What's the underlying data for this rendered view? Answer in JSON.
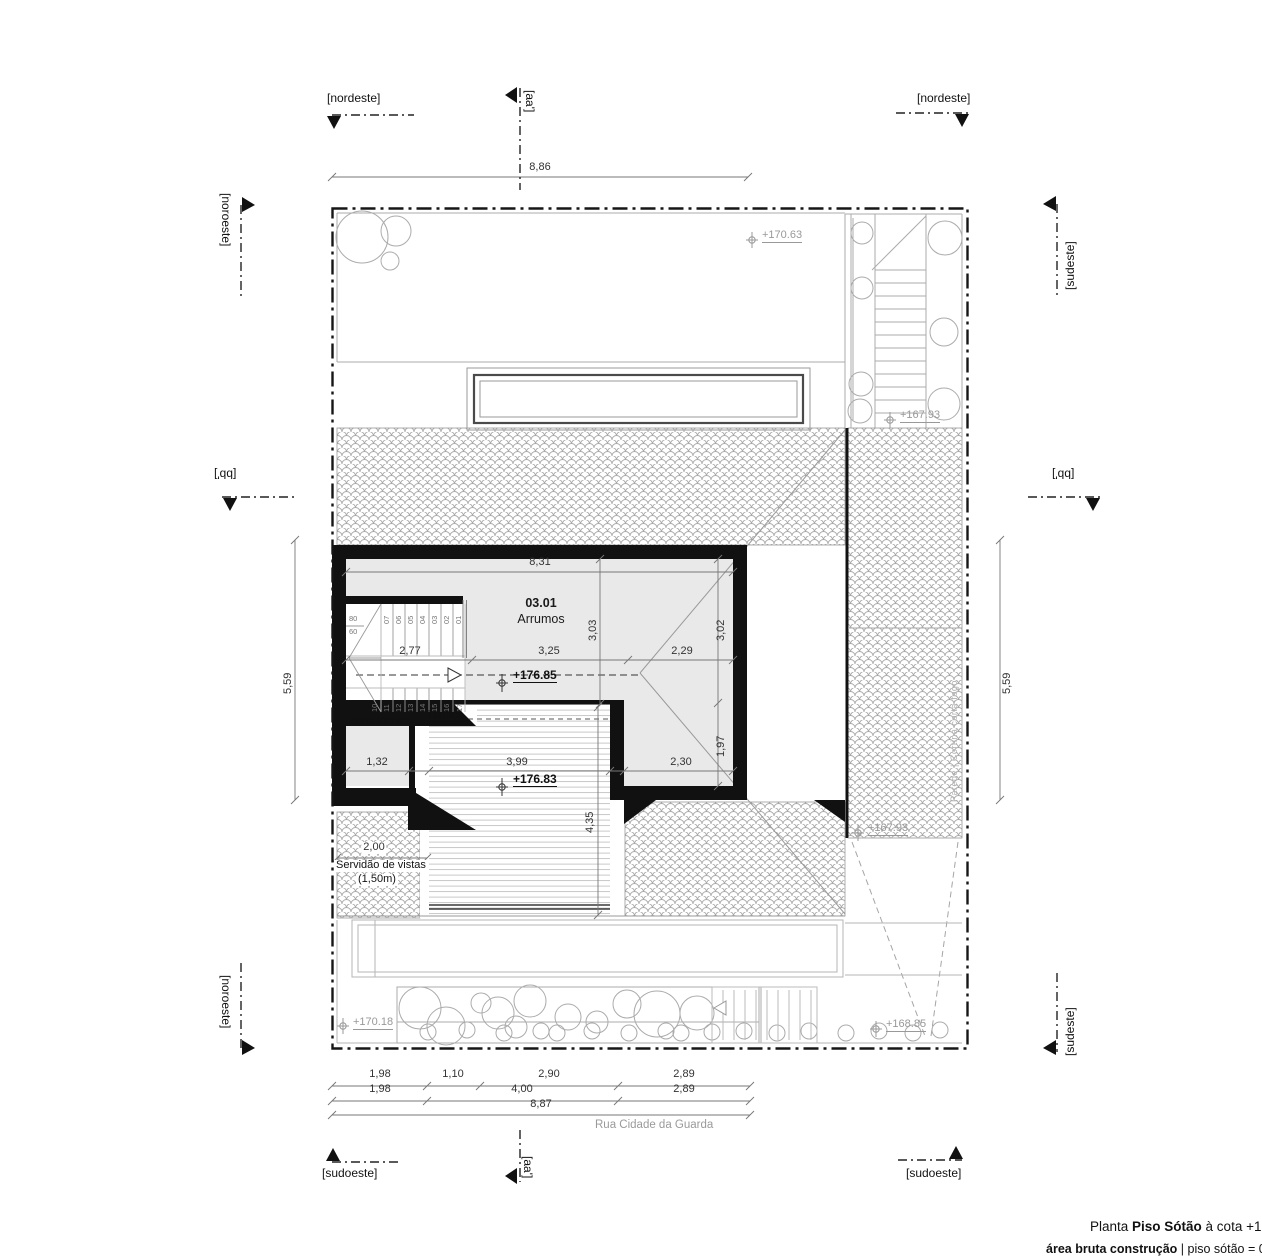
{
  "section_markers": {
    "nordeste_top_left": "[nordeste]",
    "nordeste_top_right": "[nordeste]",
    "aa_top": "[aa']",
    "aa_bottom": "[aa']",
    "noroeste_left_top": "[noroeste]",
    "noroeste_left_bottom": "[noroeste]",
    "sudeste_right_top": "[sudeste]",
    "sudeste_right_bottom": "[sudeste]",
    "bb_left": "[bb']",
    "bb_right": "[bb']",
    "sudoeste_bottom_left": "[sudoeste]",
    "sudoeste_bottom_right": "[sudoeste]"
  },
  "dimensions": {
    "site_width_top": "8,86",
    "site_height_left": "5,59",
    "site_height_right": "5,59",
    "room_width": "8,31",
    "stair_width": "2,77",
    "room_mid_width": "3,25",
    "room_right_width": "2,29",
    "room_depth_mid": "3,03",
    "room_depth_right": "3,02",
    "roof_hip_depth": "1,97",
    "zona_tecnica_width": "1,32",
    "terraco_width": "3,99",
    "right_wing_width": "2,30",
    "terraco_depth": "4,35",
    "servidao_width": "2,00",
    "chain_row1": [
      "1,98",
      "1,10",
      "2,90",
      "2,89"
    ],
    "chain_row2": [
      "1,98",
      "4,00",
      "2,89"
    ],
    "chain_total": "8,87"
  },
  "levels": {
    "garden_north": "+170.63",
    "stairs_north": "+167.93",
    "attic_floor": "+176.85",
    "terrace_floor": "+176.83",
    "roof_east": "+167.93",
    "garden_west": "+170.18",
    "garden_south": "+168.85"
  },
  "rooms": {
    "main_number": "03.01",
    "main_name": "Arrumos",
    "zona_tecnica": "Zona técnica",
    "terraco": "Terraço"
  },
  "stair": {
    "upper_treads": [
      "07",
      "06",
      "05",
      "04",
      "03",
      "02",
      "01"
    ],
    "lower_treads": [
      "10",
      "11",
      "12",
      "13",
      "14",
      "15",
      "16",
      "17"
    ],
    "width_label_top": "80",
    "width_label_bottom": "60"
  },
  "annotations": {
    "servidao_line1": "Servidão de vistas",
    "servidao_line2": "(1,50m)",
    "street_name": "Rua Cidade da Guarda",
    "parede_corta_fogo": "Parede | Cortina corta-fogo"
  },
  "title_block": {
    "line1_prefix": "Planta ",
    "line1_bold": "Piso Sótão",
    "line1_suffix": " à cota +178",
    "line2_bold": "área bruta construção",
    "line2_suffix": " | piso sótão = 03"
  },
  "colors": {
    "wall": "#111111",
    "room_fill": "#e9e9e9",
    "line_gray": "#9a9a9a",
    "level_gray": "#999999"
  }
}
